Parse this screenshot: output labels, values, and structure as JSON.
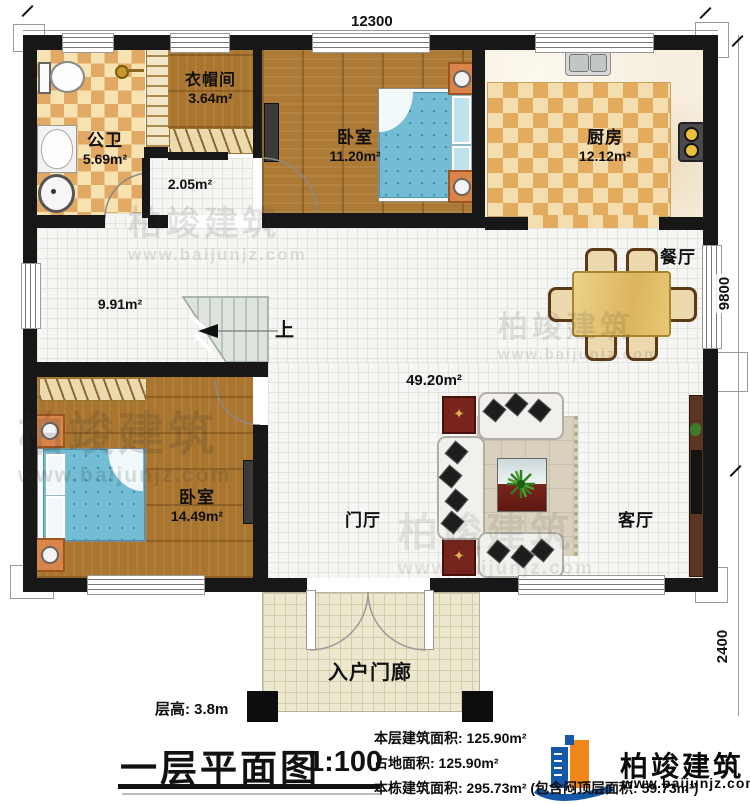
{
  "plan": {
    "dimension_top": "12300",
    "dimension_right_main": "9800",
    "dimension_right_porch": "2400",
    "stairs_up_label": "上"
  },
  "rooms": {
    "bathroom": {
      "name": "公卫",
      "area": "5.69m²"
    },
    "cloakroom": {
      "name": "衣帽间",
      "area": "3.64m²"
    },
    "hallway": {
      "area": "2.05m²"
    },
    "bedroom_top": {
      "name": "卧室",
      "area": "11.20m²"
    },
    "kitchen": {
      "name": "厨房",
      "area": "12.12m²"
    },
    "dining": {
      "name": "餐厅"
    },
    "corridor": {
      "area": "9.91m²"
    },
    "open_living": {
      "area": "49.20m²"
    },
    "bedroom_bottom": {
      "name": "卧室",
      "area": "14.49m²"
    },
    "foyer": {
      "name": "门厅"
    },
    "living": {
      "name": "客厅"
    },
    "porch": {
      "name": "入户门廊"
    }
  },
  "titleblock": {
    "floor_height": "层高: 3.8m",
    "title": "一层平面图",
    "scale": "1:100",
    "stats": [
      "本层建筑面积: 125.90m²",
      "占地面积: 125.90m²",
      "本栋建筑面积: 295.73m² (包含闷顶层面积: 59.73m²)"
    ]
  },
  "brand": {
    "name": "柏竣建筑",
    "website": "www.baijunjz.com",
    "logo_blue": "#1558a8",
    "logo_orange": "#f08519"
  }
}
